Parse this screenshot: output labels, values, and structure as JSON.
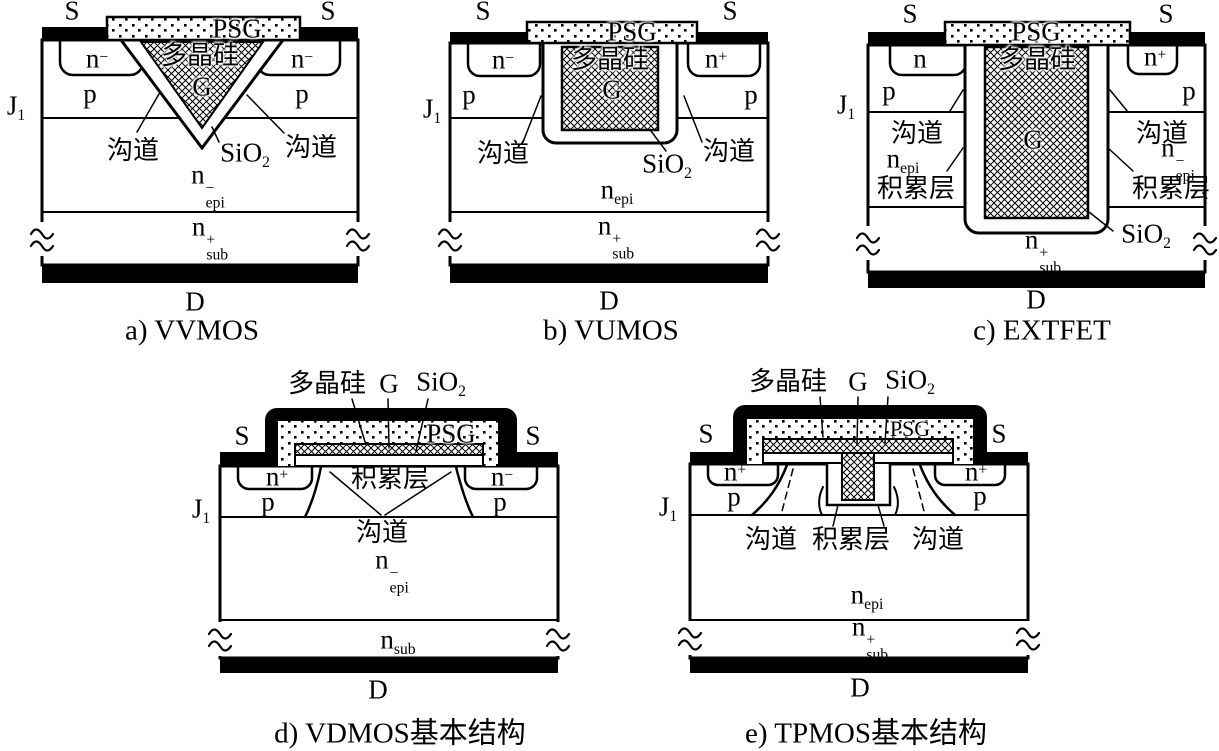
{
  "colors": {
    "ink": "#000000",
    "paper": "#ffffff"
  },
  "panels": [
    {
      "id": "a",
      "caption": "a) VVMOS",
      "source_left": "S",
      "source_right": "S",
      "drain": "D",
      "psg": "PSG",
      "poly": "多晶硅",
      "gate": "G",
      "junction": {
        "base": "J",
        "sub": "1"
      },
      "n_left": {
        "base": "n",
        "sup": "−"
      },
      "n_right": {
        "base": "n",
        "sup": "−"
      },
      "p_left": "p",
      "p_right": "p",
      "channel_left": "沟道",
      "channel_right": "沟道",
      "oxide": {
        "base": "SiO",
        "sub": "2"
      },
      "epi": {
        "base": "n",
        "sup": "−",
        "sub": "epi"
      },
      "substrate": {
        "base": "n",
        "sup": "+",
        "sub": "sub"
      }
    },
    {
      "id": "b",
      "caption": "b) VUMOS",
      "source_left": "S",
      "source_right": "S",
      "drain": "D",
      "psg": "PSG",
      "poly": "多晶硅",
      "gate": "G",
      "junction": {
        "base": "J",
        "sub": "1"
      },
      "n_left": {
        "base": "n",
        "sup": "−"
      },
      "n_right": {
        "base": "n",
        "sup": "+"
      },
      "p_left": "p",
      "p_right": "p",
      "channel_left": "沟道",
      "channel_right": "沟道",
      "oxide": {
        "base": "SiO",
        "sub": "2"
      },
      "epi": {
        "base": "n",
        "sub": "epi"
      },
      "substrate": {
        "base": "n",
        "sup": "+",
        "sub": "sub"
      }
    },
    {
      "id": "c",
      "caption": "c) EXTFET",
      "source_left": "S",
      "source_right": "S",
      "drain": "D",
      "psg": "PSG",
      "poly": "多晶硅",
      "gate": "G",
      "junction": {
        "base": "J",
        "sub": "1"
      },
      "n_left": {
        "base": "n"
      },
      "n_right": {
        "base": "n",
        "sup": "+"
      },
      "p_left": "p",
      "p_right": "p",
      "channel_left": "沟道",
      "channel_right": "沟道",
      "epi_left": {
        "base": "n",
        "sub": "epi"
      },
      "epi_right": {
        "base": "n",
        "sup": "−",
        "sub": "epi"
      },
      "accum_left": "积累层",
      "accum_right": "积累层",
      "oxide": {
        "base": "SiO",
        "sub": "2"
      },
      "substrate": {
        "base": "n",
        "sup": "+",
        "sub": "sub"
      }
    },
    {
      "id": "d",
      "caption": "d) VDMOS基本结构",
      "source_left": "S",
      "source_right": "S",
      "drain": "D",
      "psg": "PSG",
      "poly": "多晶硅",
      "gate": "G",
      "junction": {
        "base": "J",
        "sub": "1"
      },
      "n_left": {
        "base": "n",
        "sup": "+"
      },
      "n_right": {
        "base": "n",
        "sup": "−"
      },
      "p_left": "p",
      "p_right": "p",
      "accum": "积累层",
      "channel": "沟道",
      "oxide": {
        "base": "SiO",
        "sub": "2"
      },
      "epi": {
        "base": "n",
        "sup": "−",
        "sub": "epi"
      },
      "substrate": {
        "base": "n",
        "sub": "sub"
      }
    },
    {
      "id": "e",
      "caption": "e) TPMOS基本结构",
      "source_left": "S",
      "source_right": "S",
      "drain": "D",
      "psg": "PSG",
      "poly": "多晶硅",
      "gate": "G",
      "junction": {
        "base": "J",
        "sub": "1"
      },
      "n_left": {
        "base": "n",
        "sup": "+"
      },
      "n_right": {
        "base": "n",
        "sup": "+"
      },
      "p_left": "p",
      "p_right": "p",
      "channel_left": "沟道",
      "accum": "积累层",
      "channel_right": "沟道",
      "oxide": {
        "base": "SiO",
        "sub": "2"
      },
      "epi": {
        "base": "n",
        "sub": "epi"
      },
      "substrate": {
        "base": "n",
        "sup": "+",
        "sub": "sub"
      }
    }
  ]
}
